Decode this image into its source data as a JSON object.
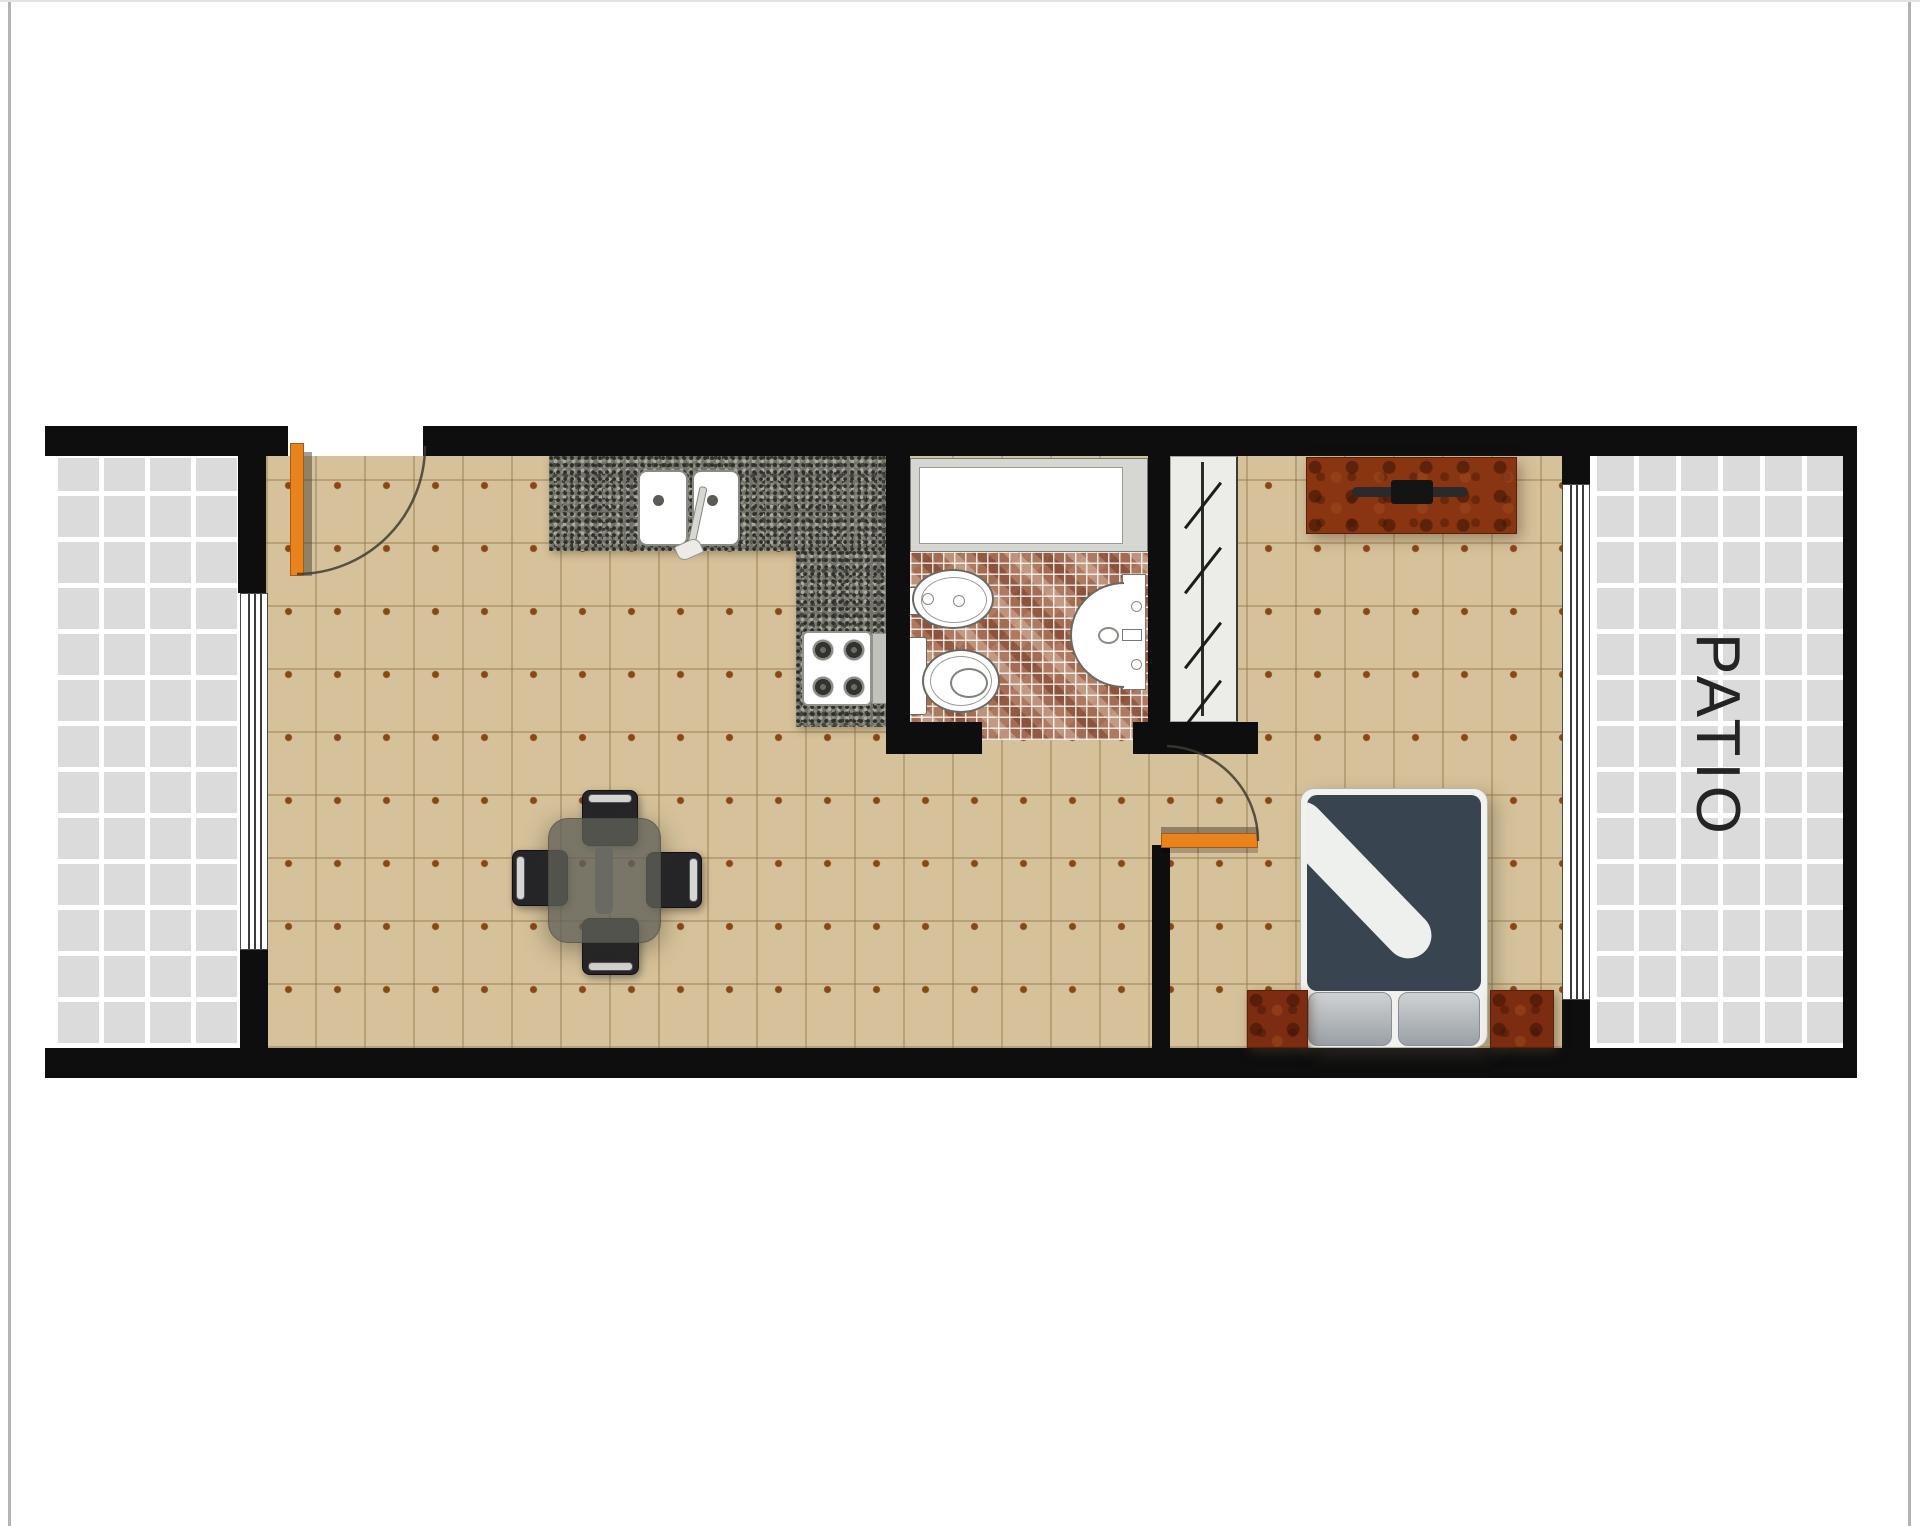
{
  "floor_plan": {
    "patio_label": "PATIO",
    "rooms": [
      "patio-left",
      "living-dining-kitchen",
      "bathroom",
      "closet",
      "bedroom",
      "patio-right"
    ],
    "fixtures": [
      "entry-door",
      "kitchen-counter",
      "kitchen-double-sink",
      "stove",
      "bathtub",
      "bidet",
      "toilet",
      "wall-sink",
      "closet-rod-with-hangers",
      "bedroom-door",
      "dresser",
      "double-bed",
      "nightstand-left",
      "nightstand-right",
      "dining-table",
      "dining-chair-top",
      "dining-chair-left",
      "dining-chair-right",
      "dining-chair-bottom",
      "window-living",
      "window-bedroom"
    ],
    "colors": {
      "wall": "#0e0e0e",
      "floor_tile": "#d6c29a",
      "floor_dot": "#8a4716",
      "patio_tile": "#dbdbdb",
      "granite_counter": "#72726a",
      "bathroom_mosaic": "#ad7a60",
      "door": "#e8831d",
      "duvet": "#38444f",
      "wood_furniture": "#8a3512",
      "label_text": "#242424",
      "page_edge": "#b3b3b3"
    }
  }
}
